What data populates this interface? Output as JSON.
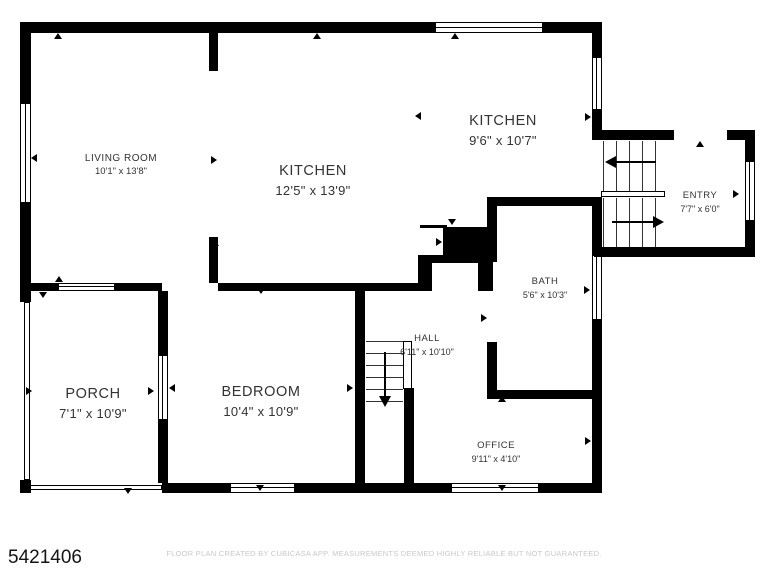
{
  "plan": {
    "id": "5421406",
    "disclaimer": "FLOOR PLAN CREATED BY CUBICASA APP. MEASUREMENTS DEEMED HIGHLY RELIABLE BUT NOT GUARANTEED.",
    "rooms": [
      {
        "name": "LIVING ROOM",
        "dims": "10'1\" x 13'8\""
      },
      {
        "name": "KITCHEN",
        "dims": "12'5\" x 13'9\""
      },
      {
        "name": "KITCHEN",
        "dims": "9'6\" x 10'7\""
      },
      {
        "name": "ENTRY",
        "dims": "7'7\" x 6'0\""
      },
      {
        "name": "BATH",
        "dims": "5'6\" x 10'3\""
      },
      {
        "name": "HALL",
        "dims": "6'11\" x 10'10\""
      },
      {
        "name": "PORCH",
        "dims": "7'1\" x 10'9\""
      },
      {
        "name": "BEDROOM",
        "dims": "10'4\" x 10'9\""
      },
      {
        "name": "OFFICE",
        "dims": "9'11\" x 4'10\""
      }
    ],
    "colors": {
      "wall": "#000000",
      "label": "#333333",
      "disclaimer": "#c8c8c8"
    }
  }
}
